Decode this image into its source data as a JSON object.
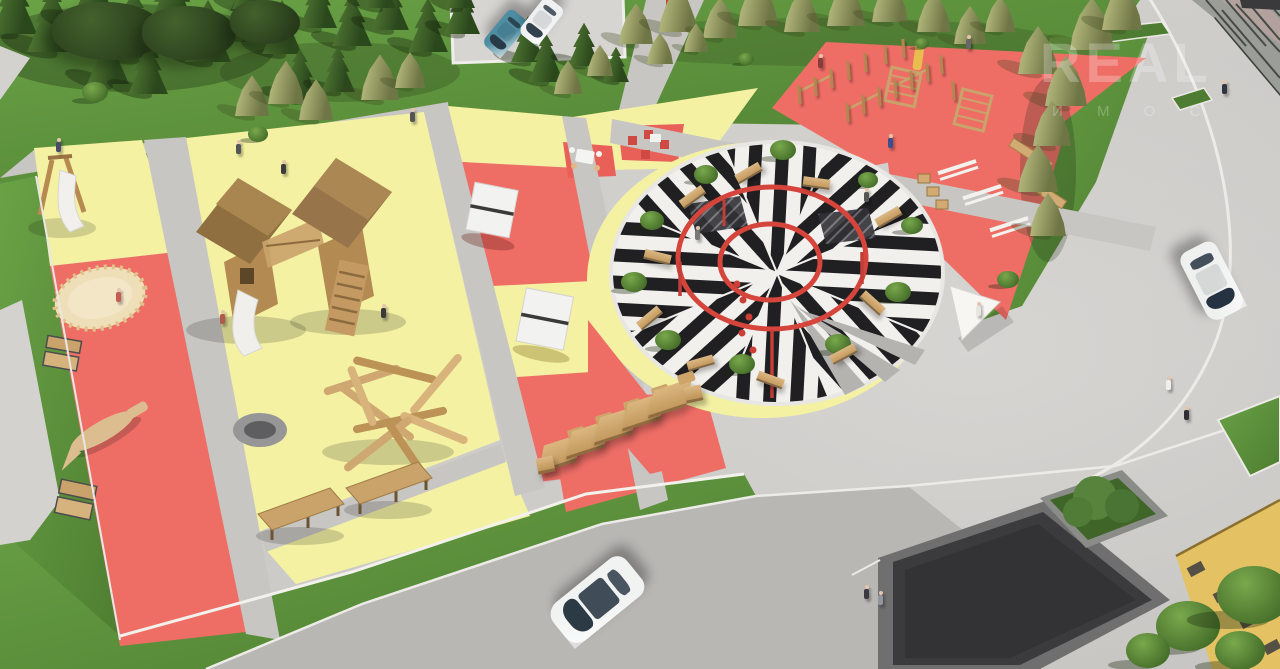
{
  "watermark": {
    "line1": "REAL",
    "line2": "И М О С"
  },
  "palette": {
    "red_zone": "#EE6E66",
    "yellow_zone": "#F4F1A3",
    "grass": "#5F9440",
    "pavement": "#CFCDCA",
    "road": "#B9B7B4",
    "path": "#C8C6C2",
    "stripe_dark": "#202023",
    "stripe_light": "#F2F0EC",
    "ring_red": "#D5453C",
    "wood": "#C9A36B",
    "white_equipment": "#F3F2EF",
    "pavilion_roof": "#3B3B3D",
    "building_yellow": "#E4C263",
    "sand": "#EEDFB8"
  },
  "scene": {
    "conifers": [
      [
        14,
        34,
        46
      ],
      [
        52,
        52,
        50
      ],
      [
        94,
        28,
        52
      ],
      [
        134,
        58,
        50
      ],
      [
        172,
        34,
        54
      ],
      [
        208,
        62,
        46
      ],
      [
        244,
        36,
        42
      ],
      [
        282,
        54,
        40
      ],
      [
        318,
        28,
        38
      ],
      [
        352,
        46,
        40
      ],
      [
        390,
        30,
        38
      ],
      [
        428,
        52,
        40
      ],
      [
        462,
        34,
        36
      ],
      [
        528,
        62,
        34
      ],
      [
        108,
        84,
        42
      ],
      [
        148,
        94,
        40
      ],
      [
        546,
        82,
        36
      ],
      [
        584,
        66,
        32
      ],
      [
        616,
        82,
        26
      ],
      [
        300,
        100,
        38
      ],
      [
        338,
        92,
        34
      ],
      [
        250,
        9,
        36
      ],
      [
        380,
        8,
        32
      ],
      [
        460,
        8,
        30
      ]
    ],
    "olives": [
      [
        252,
        116,
        34
      ],
      [
        286,
        104,
        36
      ],
      [
        316,
        120,
        34
      ],
      [
        380,
        100,
        38
      ],
      [
        410,
        88,
        30
      ],
      [
        636,
        44,
        34
      ],
      [
        678,
        32,
        38
      ],
      [
        720,
        38,
        34
      ],
      [
        758,
        26,
        40
      ],
      [
        802,
        32,
        36
      ],
      [
        846,
        26,
        38
      ],
      [
        890,
        22,
        36
      ],
      [
        934,
        32,
        34
      ],
      [
        970,
        44,
        32
      ],
      [
        1000,
        32,
        30
      ],
      [
        1038,
        74,
        40
      ],
      [
        1066,
        106,
        42
      ],
      [
        1092,
        50,
        44
      ],
      [
        1122,
        30,
        40
      ],
      [
        1052,
        146,
        38
      ],
      [
        1038,
        192,
        40
      ],
      [
        1048,
        236,
        36
      ],
      [
        568,
        94,
        28
      ],
      [
        600,
        76,
        26
      ],
      [
        660,
        64,
        26
      ],
      [
        696,
        52,
        24
      ]
    ],
    "bushes": [
      [
        95,
        100,
        26
      ],
      [
        258,
        140,
        20
      ],
      [
        1008,
        286,
        22
      ],
      [
        1188,
        646,
        64
      ],
      [
        1254,
        618,
        74
      ],
      [
        1148,
        664,
        44
      ],
      [
        746,
        64,
        16
      ],
      [
        922,
        48,
        14
      ],
      [
        1240,
        666,
        50
      ]
    ],
    "birches": [
      [
        52,
        2,
        112,
        58
      ],
      [
        142,
        6,
        94,
        54
      ],
      [
        230,
        0,
        70,
        44
      ]
    ],
    "circle_trees": [
      [
        783,
        158,
        26
      ],
      [
        706,
        182,
        24
      ],
      [
        652,
        228,
        24
      ],
      [
        634,
        290,
        26
      ],
      [
        668,
        348,
        26
      ],
      [
        742,
        372,
        26
      ],
      [
        838,
        352,
        26
      ],
      [
        898,
        300,
        26
      ],
      [
        912,
        232,
        22
      ],
      [
        868,
        186,
        20
      ]
    ],
    "circle_benches": [
      [
        748,
        172,
        -30
      ],
      [
        692,
        196,
        -36
      ],
      [
        657,
        256,
        14
      ],
      [
        649,
        317,
        -40
      ],
      [
        700,
        362,
        -16
      ],
      [
        770,
        379,
        20
      ],
      [
        843,
        353,
        -28
      ],
      [
        872,
        302,
        42
      ],
      [
        888,
        216,
        -30
      ],
      [
        816,
        182,
        8
      ]
    ],
    "posts": [
      [
        798,
        104
      ],
      [
        814,
        96
      ],
      [
        830,
        88
      ],
      [
        847,
        80
      ],
      [
        864,
        72
      ],
      [
        846,
        122
      ],
      [
        862,
        114
      ],
      [
        878,
        106
      ],
      [
        894,
        98
      ],
      [
        910,
        90
      ],
      [
        926,
        82
      ],
      [
        884,
        64
      ],
      [
        902,
        58
      ],
      [
        940,
        74
      ],
      [
        952,
        100
      ]
    ],
    "loungers": [
      [
        560,
        452
      ],
      [
        588,
        438
      ],
      [
        616,
        424
      ],
      [
        644,
        410
      ],
      [
        670,
        397
      ]
    ],
    "crates": [
      [
        545,
        463
      ],
      [
        693,
        392
      ]
    ],
    "people": [
      [
        238,
        152,
        "#555555"
      ],
      [
        283,
        172,
        "#3c3c3c"
      ],
      [
        383,
        316,
        "#3a3a3a"
      ],
      [
        222,
        322,
        "#b05a4e"
      ],
      [
        118,
        300,
        "#c75d52"
      ],
      [
        58,
        150,
        "#4a4a6a"
      ],
      [
        890,
        146,
        "#3d4d8f"
      ],
      [
        820,
        66,
        "#8a3b3b"
      ],
      [
        968,
        47,
        "#666666"
      ],
      [
        1168,
        388,
        "#f0efec"
      ],
      [
        1186,
        418,
        "#2f2f33"
      ],
      [
        866,
        597,
        "#3a3a40"
      ],
      [
        880,
        603,
        "#9096a0"
      ],
      [
        1224,
        92,
        "#2e3642"
      ],
      [
        866,
        200,
        "#555555"
      ],
      [
        978,
        314,
        "#e8e6e0"
      ],
      [
        697,
        238,
        "#777777"
      ],
      [
        412,
        120,
        "#555555"
      ]
    ],
    "cars": [
      {
        "x": 505,
        "y": 33,
        "rot": 220,
        "len": 46,
        "wid": 25,
        "body": "#4e8ea2",
        "glass": "#273a45"
      },
      {
        "x": 541,
        "y": 21,
        "rot": 218,
        "len": 46,
        "wid": 25,
        "body": "#eef0f1",
        "glass": "#31414d"
      },
      {
        "x": 597,
        "y": 600,
        "rot": 231,
        "len": 96,
        "wid": 48,
        "body": "#f1f2f2",
        "glass": "#2c3a46"
      },
      {
        "x": 1212,
        "y": 281,
        "rot": 153,
        "len": 76,
        "wid": 40,
        "body": "#eff0f0",
        "glass": "#253241"
      }
    ]
  }
}
